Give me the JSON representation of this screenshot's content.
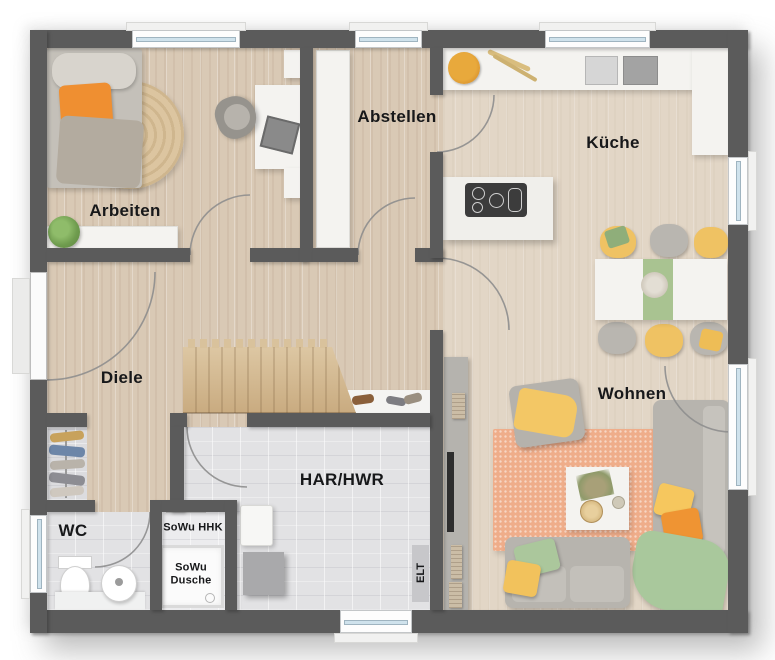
{
  "plan_type": "floorplan-top-view",
  "rooms": {
    "arbeiten": {
      "label": "Arbeiten"
    },
    "abstellen": {
      "label": "Abstellen"
    },
    "kueche": {
      "label": "Küche"
    },
    "diele": {
      "label": "Diele"
    },
    "wohnen": {
      "label": "Wohnen"
    },
    "wc": {
      "label": "WC"
    },
    "har_hwr": {
      "label": "HAR/HWR"
    },
    "sowu_hhk": {
      "label": "SoWu HHK"
    },
    "sowu_dusche": {
      "label": "SoWu Dusche"
    },
    "elt": {
      "label": "ELT"
    }
  },
  "colors": {
    "wall": "#5b5b5b",
    "wood_floor": "#d9c9b5",
    "tile_floor": "#e2e2e4",
    "counter_white": "#f4f3f0",
    "sofa_gray": "#b7b4ae",
    "accent_orange": "#ef9433",
    "accent_yellow": "#f2c45e",
    "accent_green": "#a9c79b",
    "rug_orange": "#efad8a",
    "stair_wood": "#d5bc96"
  }
}
